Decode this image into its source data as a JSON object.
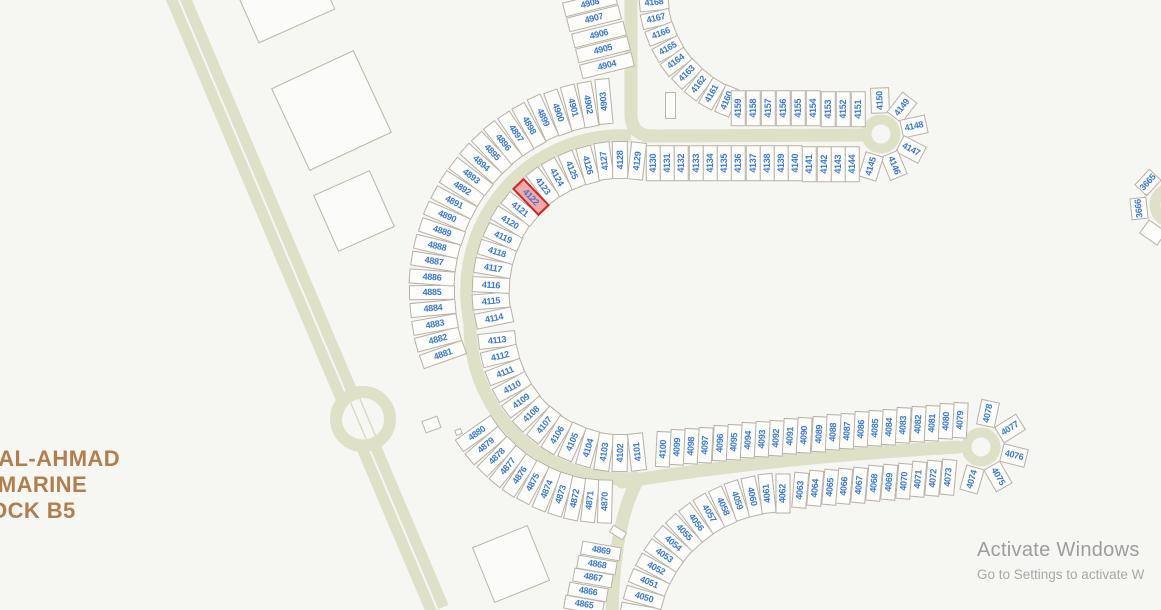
{
  "map": {
    "title_block": {
      "line1": "AH AL-AHMAD",
      "line2": "AL-MARINE",
      "line3": "BLOCK B5"
    },
    "watermark": {
      "line1": "Activate Windows",
      "line2": "Go to Settings to activate W"
    },
    "selected_plot": "4122",
    "colors": {
      "background": "#f6f6f3",
      "road": "#dee0c8",
      "road_lane_line": "#d6d8bd",
      "plot_fill": "#fdfdfc",
      "plot_border": "#b9b0a2",
      "plot_number": "#3a78d4",
      "selected_fill": "#f4a9a9",
      "selected_border": "#cb2727",
      "block_text": "#b17f4f"
    },
    "plot_groups": [
      {
        "name": "north-column",
        "type": "line",
        "x1": 590,
        "y1": 3,
        "x2": 607,
        "y2": 65,
        "angle": -14,
        "rw": 54,
        "tw": 15,
        "numbers": [
          "4908",
          "4907",
          "4906",
          "4905",
          "4904"
        ]
      },
      {
        "name": "outer-ring-west",
        "type": "arc",
        "cx": 622,
        "cy": 291,
        "r": 190,
        "a1": 160.5,
        "a2": 264.5,
        "rw": 46,
        "tw": 15,
        "numbers": [
          "4881",
          "4882",
          "4883",
          "4884",
          "4885",
          "4886",
          "4887",
          "4888",
          "4889",
          "4890",
          "4891",
          "4892",
          "4893",
          "4894",
          "4895",
          "4896",
          "4897",
          "4898",
          "4899",
          "4900",
          "4901",
          "4902",
          "4903"
        ]
      },
      {
        "name": "inner-ring-north",
        "type": "arc",
        "cx": 622,
        "cy": 291,
        "r": 131,
        "a1": 168.3,
        "a2": 276.4,
        "rw": 38,
        "tw": 16,
        "numbers": [
          "4114",
          "4115",
          "4116",
          "4117",
          "4118",
          "4119",
          "4120",
          "4121",
          "4122",
          "4123",
          "4124",
          "4125",
          "4126",
          "4127",
          "4128",
          "4129"
        ]
      },
      {
        "name": "inner-ring-south",
        "type": "arc",
        "cx": 623,
        "cy": 326,
        "r": 127,
        "a1": 173.7,
        "a2": 83.7,
        "rw": 38,
        "tw": 16,
        "numbers": [
          "4113",
          "4112",
          "4111",
          "4110",
          "4109",
          "4108",
          "4107",
          "4106",
          "4105",
          "4104",
          "4103",
          "4102",
          "4101"
        ]
      },
      {
        "name": "outer-ring-south",
        "type": "arc",
        "cx": 609,
        "cy": 341,
        "r": 161,
        "a1": 145,
        "a2": 91.4,
        "rw": 44,
        "tw": 15,
        "numbers": [
          "4880",
          "4879",
          "4878",
          "4877",
          "4876",
          "4875",
          "4874",
          "4873",
          "4872",
          "4871",
          "4870"
        ]
      },
      {
        "name": "south-column-west",
        "type": "line",
        "x1": 601,
        "y1": 551,
        "x2": 584,
        "y2": 605,
        "angle": 10,
        "rw": 40,
        "tw": 13.5,
        "numbers": [
          "4869",
          "4868",
          "4867",
          "4866",
          "4865"
        ]
      },
      {
        "name": "inner-ring-southeast",
        "type": "arc",
        "cx": 783,
        "cy": 638,
        "r": 145,
        "a1": 190,
        "a2": 270,
        "rw": 40,
        "tw": 15,
        "numbers": [
          "",
          "4050",
          "4051",
          "4052",
          "4053",
          "4054",
          "4055",
          "4056",
          "4057",
          "4058",
          "4059",
          "4060",
          "4061",
          "4062"
        ]
      },
      {
        "name": "south-street-lower-row",
        "type": "line",
        "x1": 800,
        "y1": 490,
        "x2": 948,
        "y2": 477,
        "angle": -85,
        "rw": 36,
        "tw": 14.5,
        "numbers": [
          "4063",
          "4064",
          "4065",
          "4066",
          "4067",
          "4068",
          "4069",
          "4070",
          "4071",
          "4072",
          "4073"
        ]
      },
      {
        "name": "south-street-culdesac",
        "type": "arc",
        "cx": 981,
        "cy": 447,
        "r": 34,
        "a1": 106,
        "a2": -78,
        "rw": 26,
        "tw": 19,
        "numbers": [
          "4074",
          "4075",
          "4076",
          "4077",
          "4078"
        ]
      },
      {
        "name": "south-street-upper-row",
        "type": "line",
        "x1": 663,
        "y1": 449,
        "x2": 960,
        "y2": 420,
        "angle": -87,
        "rw": 36,
        "tw": 14.5,
        "numbers": [
          "4100",
          "4099",
          "4098",
          "4097",
          "4096",
          "4095",
          "4094",
          "4093",
          "4092",
          "4091",
          "4090",
          "4089",
          "4088",
          "4087",
          "4086",
          "4085",
          "4084",
          "4083",
          "4082",
          "4081",
          "4080",
          "4079"
        ]
      },
      {
        "name": "north-street-bend",
        "type": "arc",
        "cx": 772,
        "cy": -9,
        "r": 119,
        "a1": 174.4,
        "a2": 112.4,
        "rw": 30,
        "tw": 15.5,
        "numbers": [
          "4168",
          "4167",
          "4166",
          "4165",
          "4164",
          "4163",
          "4162",
          "4161",
          "4160"
        ]
      },
      {
        "name": "north-street-upper-row",
        "type": "line",
        "x1": 738,
        "y1": 108,
        "x2": 858,
        "y2": 109,
        "angle": -90,
        "rw": 36,
        "tw": 14.5,
        "numbers": [
          "4159",
          "4158",
          "4157",
          "4156",
          "4155",
          "4154",
          "4153",
          "4152",
          "4151"
        ]
      },
      {
        "name": "north-street-culdesac",
        "type": "arc",
        "cx": 881,
        "cy": 134,
        "r": 34,
        "a1": -92,
        "a2": 107.4,
        "rw": 26,
        "tw": 19,
        "numbers": [
          "4150",
          "4149",
          "4148",
          "4147",
          "4146",
          "4145"
        ]
      },
      {
        "name": "north-street-lower-row",
        "type": "line",
        "x1": 653,
        "y1": 163,
        "x2": 852,
        "y2": 164,
        "angle": -90,
        "rw": 36,
        "tw": 14.5,
        "numbers": [
          "4130",
          "4131",
          "4132",
          "4133",
          "4134",
          "4135",
          "4136",
          "4137",
          "4138",
          "4139",
          "4140",
          "4141",
          "4142",
          "4143",
          "4144"
        ]
      },
      {
        "name": "east-edge-plots",
        "type": "arc",
        "cx": 1172,
        "cy": 205,
        "r": 33,
        "a1": 223,
        "a2": 125,
        "rw": 22,
        "tw": 17,
        "labels": "tangential",
        "numbers": [
          "3665",
          "3666",
          ""
        ]
      }
    ],
    "empty_parcels": [
      {
        "x": 280,
        "y": -12,
        "w": 84,
        "h": 84,
        "rot": -24
      },
      {
        "x": 331,
        "y": 110,
        "w": 91,
        "h": 91,
        "rot": -25
      },
      {
        "x": 354,
        "y": 211,
        "w": 62,
        "h": 62,
        "rot": -24
      },
      {
        "x": 511,
        "y": 564,
        "w": 60,
        "h": 60,
        "rot": -22
      },
      {
        "x": 431,
        "y": 424,
        "w": 17,
        "h": 13,
        "rot": -20
      },
      {
        "x": 458,
        "y": 432,
        "w": 7,
        "h": 6,
        "rot": -20
      },
      {
        "x": 670,
        "y": 105,
        "w": 11,
        "h": 27,
        "rot": 0
      },
      {
        "x": 618,
        "y": 532,
        "w": 16,
        "h": 9,
        "rot": 32
      }
    ]
  }
}
